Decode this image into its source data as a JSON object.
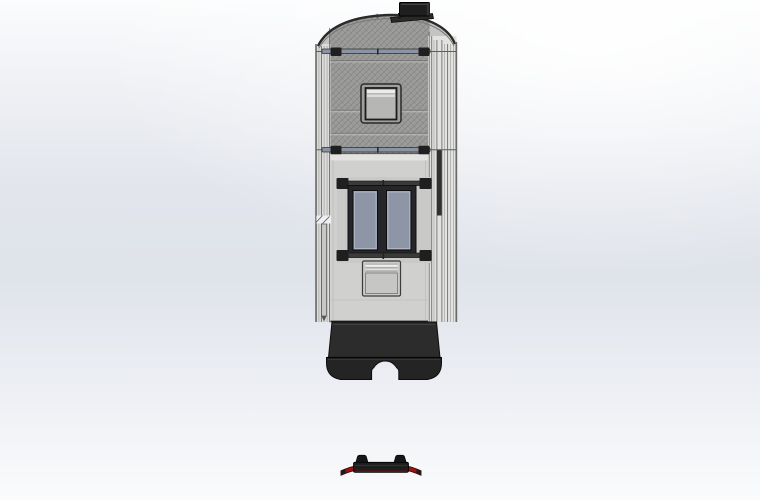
{
  "viewport": {
    "type": "cad-3d-viewport",
    "model": "camper-trailer-front-elevation-with-detached-hitch-guard"
  },
  "colors": {
    "bg_mid": "#dfe3ea",
    "outline": "#1c1c1c",
    "shell_panel": "#d0d0ce",
    "shell_panel_shade": "#c9c9c7",
    "trim_left": "#dcdcda",
    "trim_right": "#e2e2e0",
    "roof_face": "#c4c4c2",
    "roof_hatch": "#9c9c9a",
    "hatch_line": "#5f5f5d",
    "rail": "#8a94a4",
    "bracket": "#1f1f1f",
    "window_frame": "#26262a",
    "glass": "#8d95a7",
    "glass_light": "#b7bdca",
    "skylight_frame": "#9f9f9d",
    "skylight_pane": "#b6b6b4",
    "skylight_strip": "#ececea",
    "vent_body": "#cbcbc9",
    "vent_band": "#b0b0ae",
    "vent_strip": "#f0f0ee",
    "bumper": "#2c2c2c",
    "bumper_lower": "#242424",
    "ac_body": "#1f1f1f",
    "ac_face": "#343434",
    "hitch_bar": "#1d1d1d",
    "accent_red": "#9e1212",
    "accent_red_dark": "#3f0606"
  },
  "parts": {
    "ac_unit": "roof-ac-unit",
    "roof_panel": "hatched-roof-panel",
    "rail_upper": "roof-rack-rail-upper",
    "rail_lower": "roof-rack-rail-lower",
    "skylight": "roof-skylight-hatch",
    "windows": "entry-door-window-pair",
    "vent": "door-vent-panel",
    "trim_left": "side-trim-left",
    "trim_right": "side-trim-right",
    "bumper": "rear-bumper-skirt",
    "hitch_guard": "detached-hitch-guard"
  }
}
